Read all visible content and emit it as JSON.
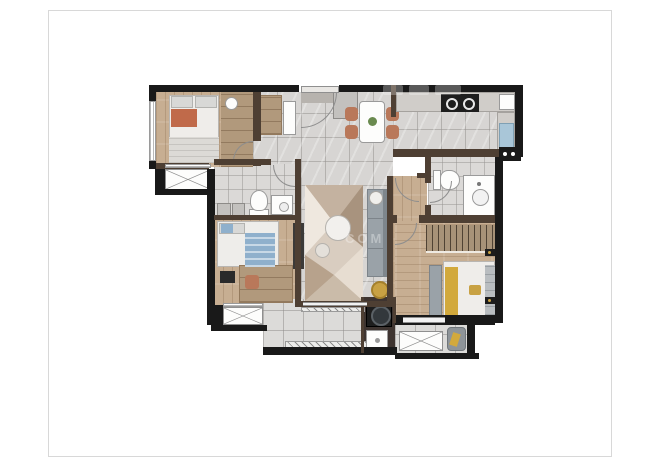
{
  "page": {
    "background": "#ffffff",
    "border_color": "#d8d8d8"
  },
  "plan": {
    "type": "apartment-floor-plan-3d-render",
    "rooms": [
      {
        "id": "bedroom-1",
        "label": "bedroom top-left with double bed and wardrobe"
      },
      {
        "id": "bay-window-1",
        "label": "bay window below bedroom 1"
      },
      {
        "id": "bathroom-a",
        "label": "shared bathroom center-left with toilet, vanity, cabinets"
      },
      {
        "id": "bedroom-2",
        "label": "bedroom mid-left with blue bed and desk"
      },
      {
        "id": "bay-window-2",
        "label": "bay window below bedroom 2"
      },
      {
        "id": "entry-hall-dining",
        "label": "entry hall and dining area with table for four"
      },
      {
        "id": "kitchen",
        "label": "kitchen top-right with cooktop and blue sink"
      },
      {
        "id": "bathroom-b",
        "label": "bathroom right-middle with toilet and vanity"
      },
      {
        "id": "corridor",
        "label": "wood corridor to master bedroom"
      },
      {
        "id": "living-room",
        "label": "living room with rug, sofa, round tables"
      },
      {
        "id": "laundry",
        "label": "laundry nook with washing machine and sink"
      },
      {
        "id": "balcony",
        "label": "main balcony bottom-center"
      },
      {
        "id": "master-bedroom",
        "label": "master bedroom bottom-right with wardrobe and bed"
      },
      {
        "id": "master-balcony",
        "label": "small balcony bottom-right with lounge chair"
      }
    ]
  },
  "watermark": {
    "fragment": "COM",
    "note": "translucent white watermark, mostly illegible"
  },
  "colors": {
    "pageborder": "#d8d8d8",
    "wallext": "#191919",
    "wallint": "#4e3f33",
    "tile": "#d7d5d3",
    "balconytile": "#dcdbd9",
    "wood": "#c7ae92",
    "woodcloset": "#b1997c",
    "counter": "#d0cdc9",
    "rugbase": "#d6cabc",
    "sofa": "#9aa2a8",
    "sofaback": "#7e868c",
    "terracotta": "#b9785a",
    "bluebed": "#8fb0cc",
    "orange": "#c06a4a",
    "gold": "#c8a143",
    "yellow": "#d2a93c",
    "sinkblue": "#a9c6d8",
    "plant": "#6a8a4f",
    "appliance": "#1e1e1e",
    "wmo": "0.32"
  }
}
